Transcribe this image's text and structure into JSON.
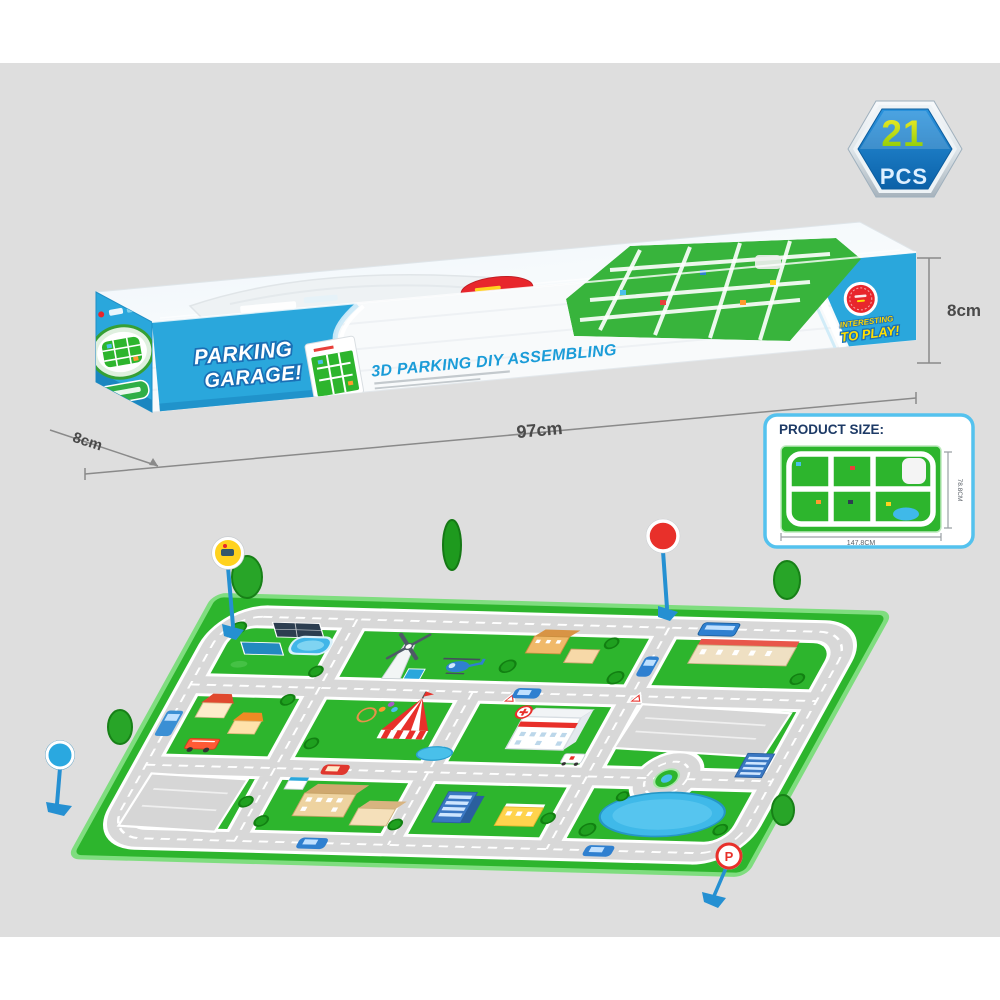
{
  "stage": {
    "background": "#dedede",
    "page_background": "#ffffff"
  },
  "badge": {
    "count": "21",
    "unit": "PCS",
    "shape": "hexagon-badge-icon",
    "fill": "#0f74c4",
    "ring": "#c9d2d9"
  },
  "box": {
    "brand": {
      "line1": "PARKING",
      "line2": "GARAGE!"
    },
    "tagline": "3D PARKING DIY ASSEMBLING",
    "end_panel": {
      "line1": "INTERESTING",
      "line2": "TO PLAY!"
    },
    "blue": "#2aa7dc"
  },
  "dimensions": {
    "length": "97cm",
    "height": "8cm",
    "depth": "8cm"
  },
  "product_size_card": {
    "title": "PRODUCT SIZE:",
    "width_label": "147.8CM",
    "height_label": "78.8CM"
  },
  "playmat": {
    "parking_sign_letter": "P",
    "colors": {
      "grass": "#2db52d",
      "road": "#d8d8d8",
      "water": "#3fb9e9"
    },
    "features": [
      "roads",
      "roundabout",
      "hospital",
      "circus-tent",
      "windmill",
      "helicopter",
      "lake",
      "parking-lots",
      "houses",
      "school",
      "office",
      "cars",
      "traffic-signs",
      "trees"
    ]
  }
}
